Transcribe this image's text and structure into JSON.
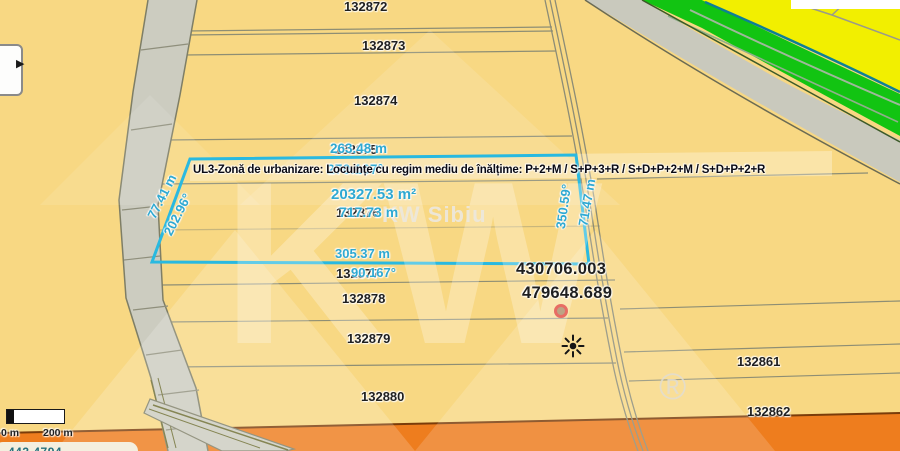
{
  "map": {
    "zone_banner": "UL3-Zonă de urbanizare: Locuințe cu regim mediu de înălțime: P+2+M / S+P+3+R / S+D+P+2+M / S+D+P+2+R",
    "selection": {
      "area": "20327.53 m²",
      "perimeter": "717.73 m",
      "top_length": "263.48 m",
      "top_bearing": "270.167°",
      "bottom_length": "305.37 m",
      "bottom_bearing": "90.167°",
      "left_length": "77.41 m",
      "left_bearing": "202.96°",
      "right_length": "71.47 m",
      "right_bearing": "350.59°"
    },
    "coordinates": {
      "x": "430706.003",
      "y": "479648.689"
    },
    "parcels": {
      "r1": "132872",
      "r2": "132873",
      "r3": "132874",
      "h1": "132875",
      "h2": "132876",
      "h3": "132877",
      "r4": "132878",
      "r5": "132879",
      "r6": "132880",
      "e1": "132861",
      "e2": "132862"
    },
    "watermark": {
      "logo": "KW",
      "brand": "KW Sibiu",
      "registered": "®"
    },
    "scale_bar": {
      "start_label": "0 m",
      "end_label": "200 m"
    },
    "status_readout": "443.4794",
    "controls": {
      "expand_arrow": "▶"
    },
    "colors": {
      "selection_outline": "#29b9e0",
      "measurement_text": "#2fa9d2",
      "zone_residential_fill": "#f8d883",
      "zone_green": "#12c412",
      "zone_yellow": "#f2ef00",
      "zone_orange": "#ee7d1e"
    }
  }
}
